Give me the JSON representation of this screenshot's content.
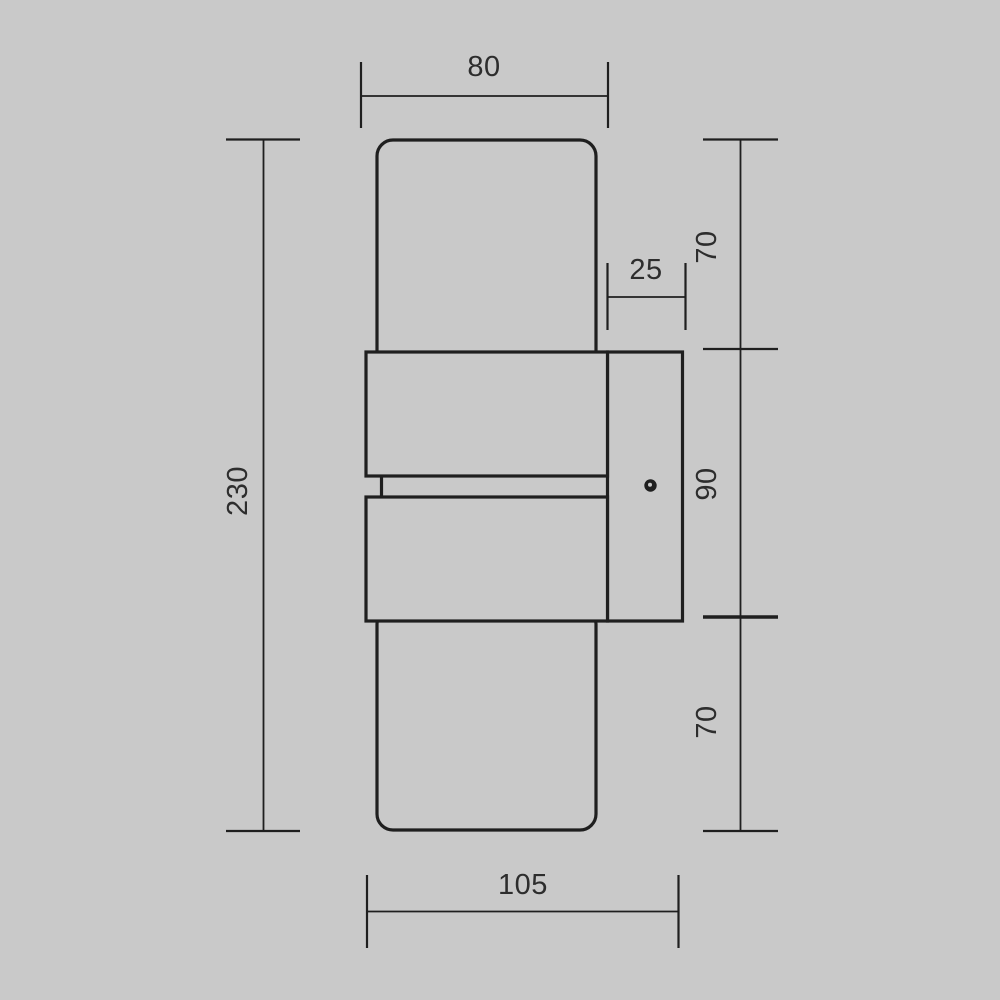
{
  "page": {
    "background_color": "#c9c9c9",
    "line_color": "#1f1f1f",
    "text_color": "#2d2d2d"
  },
  "drawing": {
    "kind": "technical-dimension-diagram",
    "subject": "wall-lamp-side-view",
    "dimensions": {
      "top_width": {
        "label": "80"
      },
      "overall_height": {
        "label": "230"
      },
      "plate_offset": {
        "label": "25"
      },
      "top_section_height": {
        "label": "70"
      },
      "middle_section_height": {
        "label": "90"
      },
      "bottom_section_height": {
        "label": "70"
      },
      "overall_depth": {
        "label": "105"
      }
    }
  }
}
